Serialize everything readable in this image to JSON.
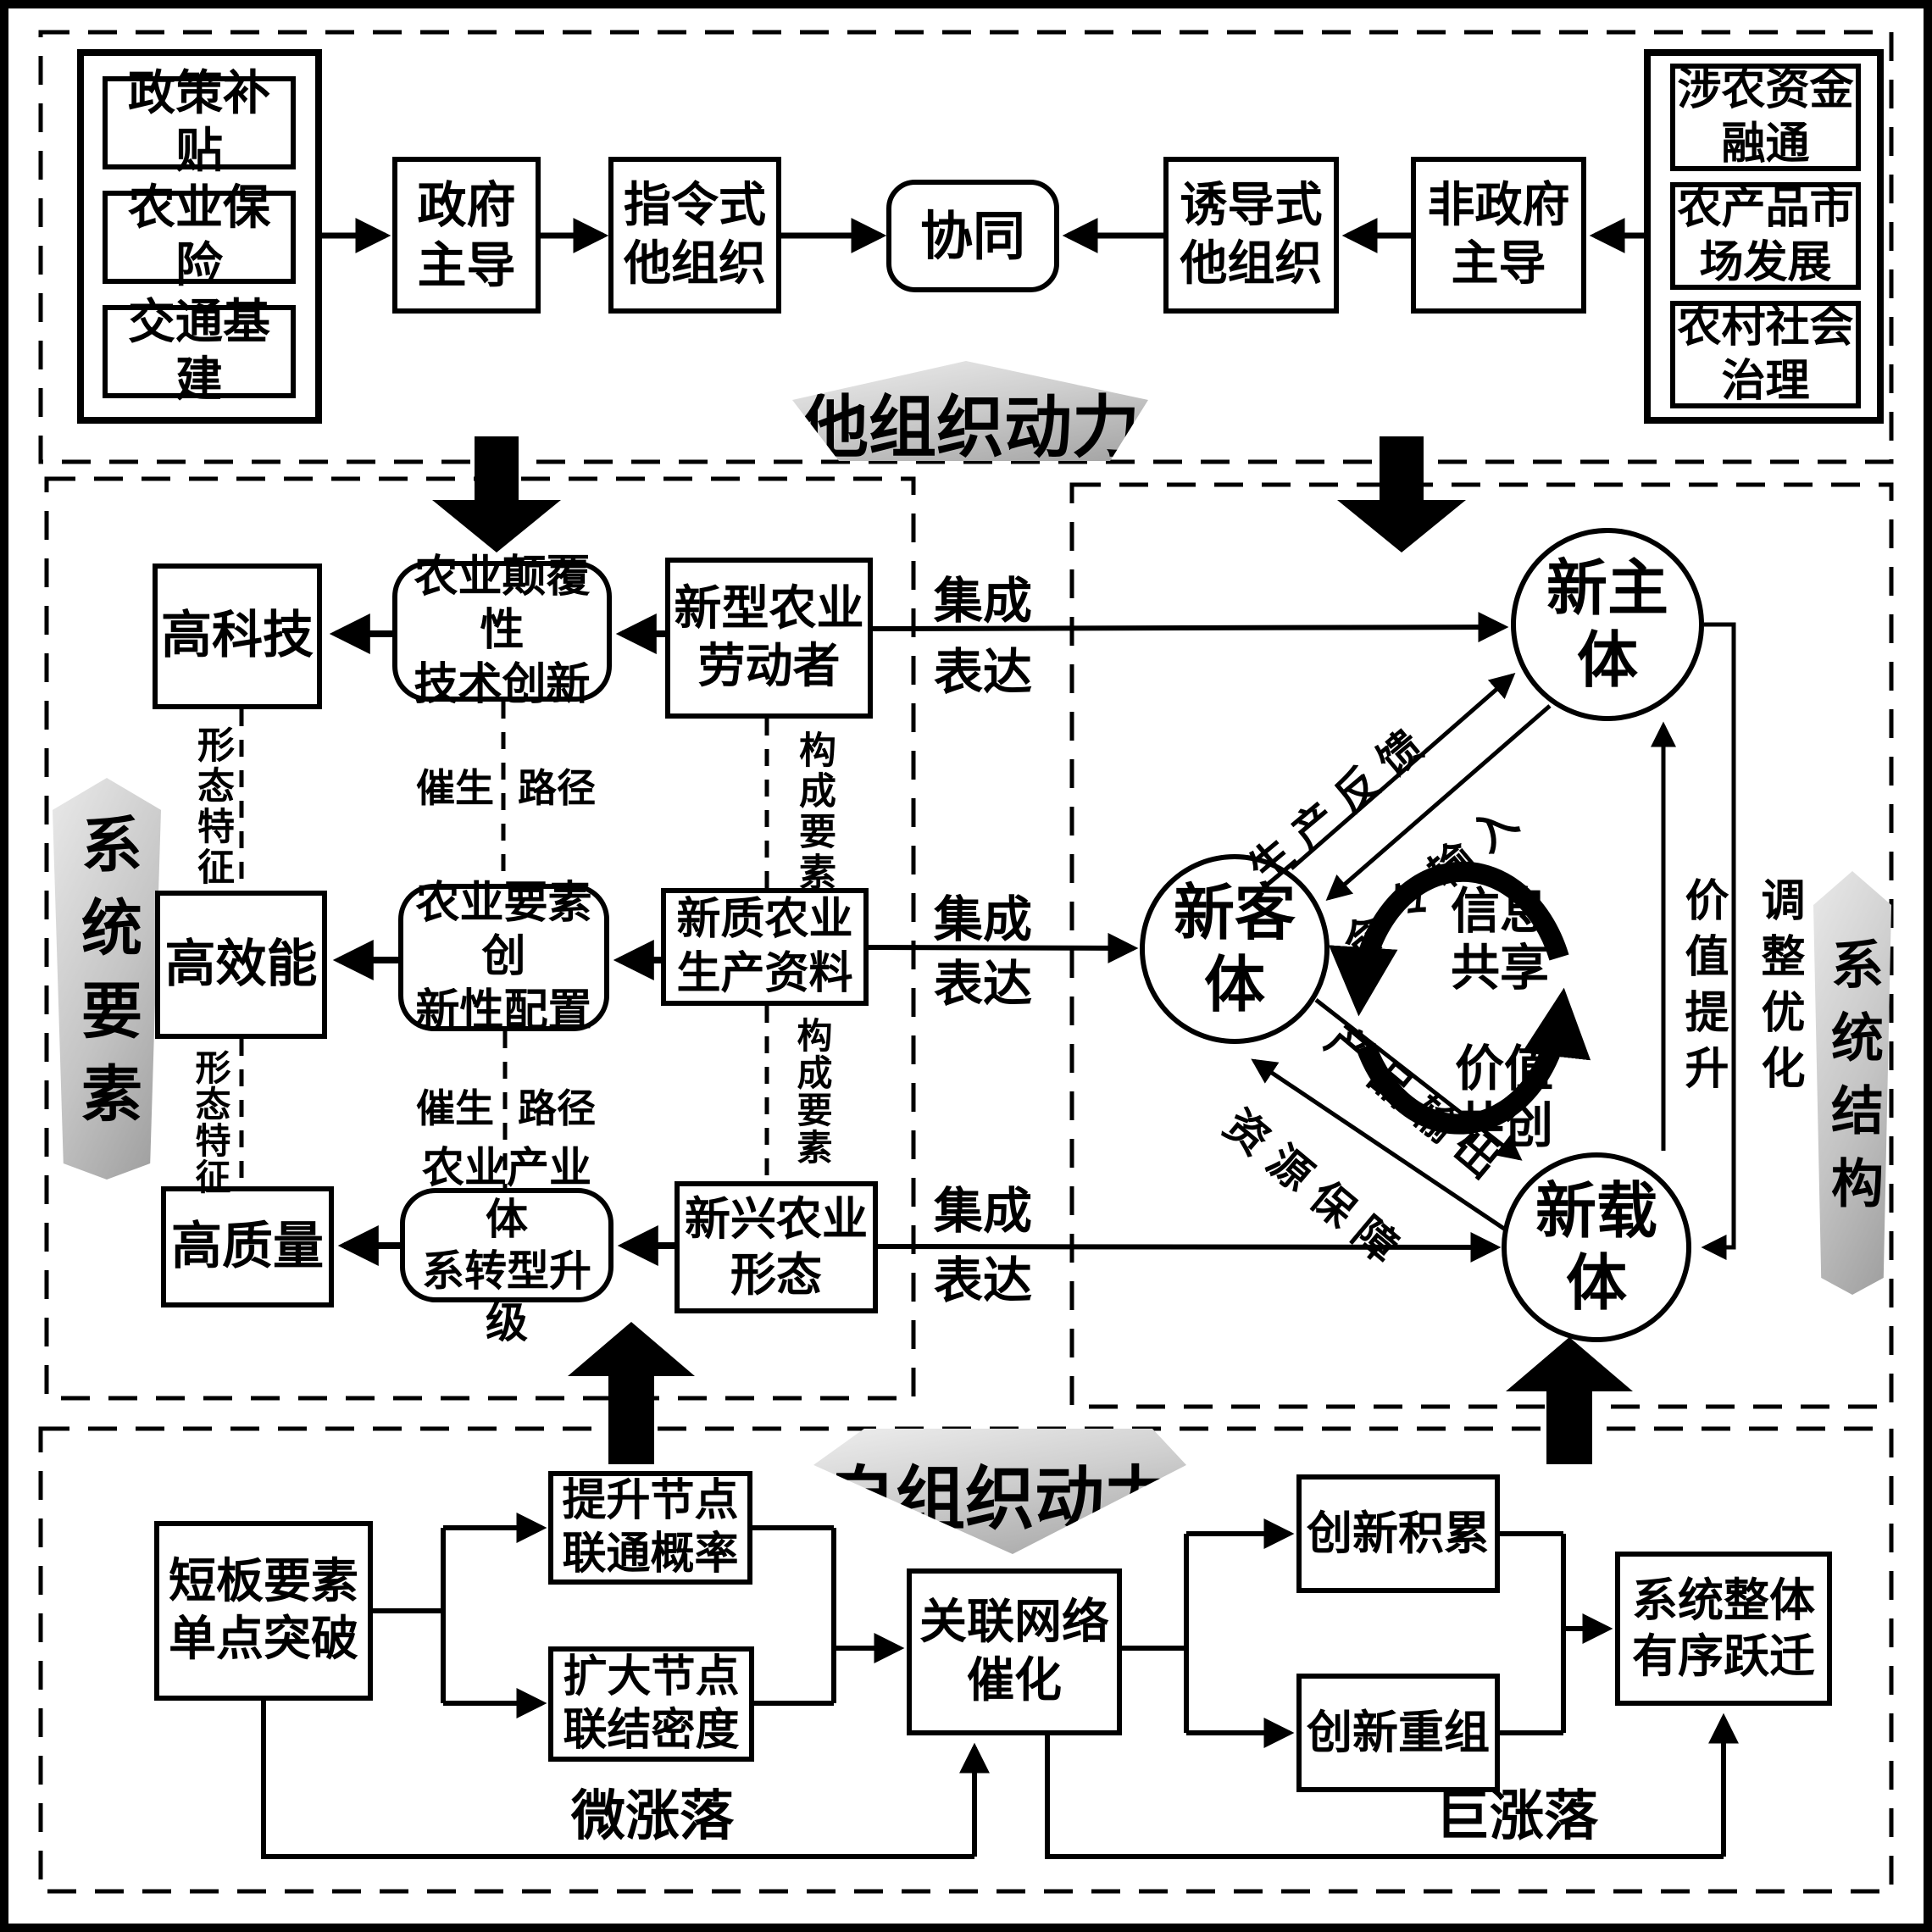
{
  "top": {
    "left_group": [
      "政策补贴",
      "农业保险",
      "交通基建"
    ],
    "right_group": [
      "涉农资金\n融通",
      "农产品市\n场发展",
      "农村社会\n治理"
    ],
    "gov_led": "政府\n主导",
    "directive_org": "指令式\n他组织",
    "synergy": "协同",
    "induced_org": "诱导式\n他组织",
    "non_gov_led": "非政府\n主导",
    "banner": "他组织动力"
  },
  "elements": {
    "side_banner": "系统要素",
    "rows": [
      {
        "trait": "高科技",
        "innovation": "农业颠覆性\n技术创新",
        "element": "新型农业\n劳动者"
      },
      {
        "trait": "高效能",
        "innovation": "农业要素创\n新性配置",
        "element": "新质农业\n生产资料"
      },
      {
        "trait": "高质量",
        "innovation": "农业产业体\n系转型升级",
        "element": "新兴农业\n形态"
      }
    ],
    "morph_label": "形态特征",
    "spawn_label": "催生",
    "route_label": "路径",
    "component_label": "构成要素",
    "integration_label": "集成",
    "expression_label": "表达"
  },
  "structure": {
    "side_banner": "系统结构",
    "subject": "新主\n体",
    "object": "新客\n体",
    "carrier": "新载\n体",
    "info_sharing": "信息\n共享",
    "value_cocreation": "价值\n共创",
    "production_feedback": "生产反馈",
    "command_input": "命令输入",
    "product_output": "产品输出",
    "resource_support": "资源保障",
    "value_upgrade": "价值提升",
    "adjust_optimize": "调整优化"
  },
  "bottom": {
    "banner": "自组织动力",
    "shortboard": "短板要素\n单点突破",
    "node_connect_prob": "提升节点\n联通概率",
    "node_link_density": "扩大节点\n联结密度",
    "network_catalysis": "关联网络\n催化",
    "innovation_accumulation": "创新积累",
    "innovation_recombination": "创新重组",
    "system_leap": "系统整体\n有序跃迁",
    "micro_fluctuation": "微涨落",
    "macro_fluctuation": "巨涨落"
  }
}
